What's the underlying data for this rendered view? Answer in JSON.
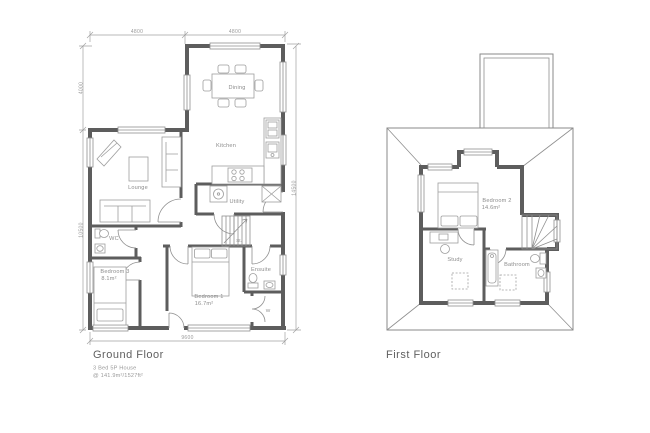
{
  "ground_floor": {
    "title": "Ground Floor",
    "subtitle": "3 Bed 5P House",
    "area_note": "@ 141.9m²/1527ft²",
    "rooms": {
      "dining": "Dining",
      "kitchen": "Kitchen",
      "lounge": "Lounge",
      "utility": "Utility",
      "stairs": "St.",
      "wc": "WC",
      "bedroom3_name": "Bedroom 3",
      "bedroom3_area": "8.1m²",
      "bedroom1_name": "Bedroom 1",
      "bedroom1_area": "16.7m²",
      "ensuite": "Ensuite",
      "wardrobe": "W"
    },
    "dimensions": {
      "top_left_width": "4800",
      "top_right_width": "4800",
      "left_upper_height": "4000",
      "left_lower_height": "10500",
      "right_height": "14500",
      "bottom_width": "9600"
    }
  },
  "first_floor": {
    "title": "First Floor",
    "rooms": {
      "bedroom2_name": "Bedroom 2",
      "bedroom2_area": "14.6m²",
      "study": "Study",
      "bathroom": "Bathroom"
    }
  }
}
